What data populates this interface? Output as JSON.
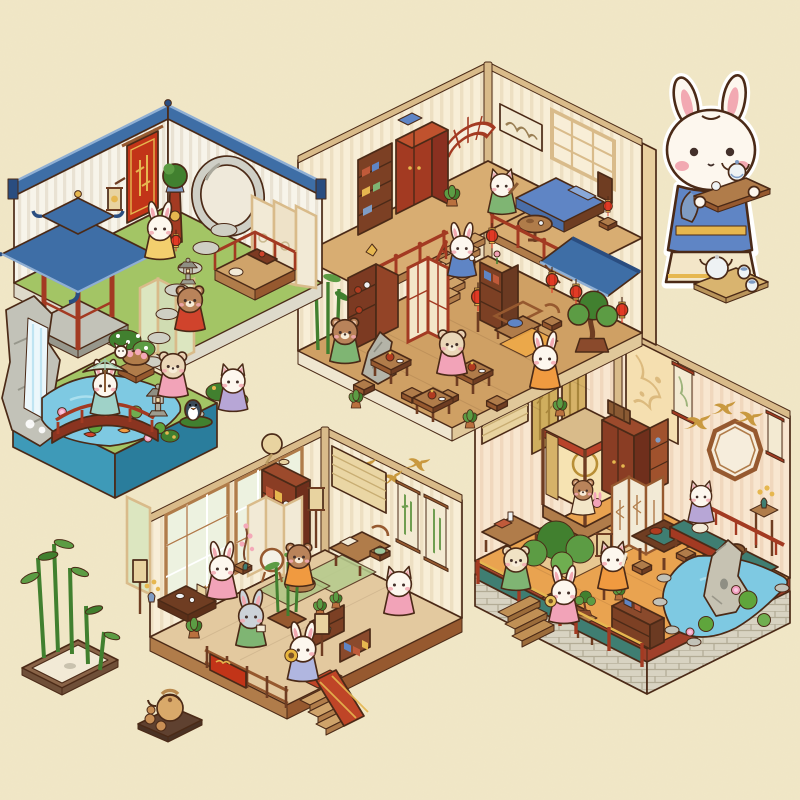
{
  "scene": {
    "description": "Isometric cutaway dollhouse illustration of a traditional Chinese courtyard home with four dioramas - a garden with koi pond and pavilion, a two-story house with bedroom and teahouse, a flower study, and a tea terrace - inhabited by cute rabbit, bear, cat and puppy figures in hanfu, drawn on speckled cream paper",
    "art_style": "pastel isometric storybook game art",
    "canvas": {
      "width": 800,
      "height": 800
    }
  },
  "palette": {
    "bg": "#f1e7c6",
    "speckle": "#d8c89a",
    "outline": "#4b2a17",
    "roofBlue": "#3e6ea6",
    "roofBlueDark": "#2a4d80",
    "roofBlueLight": "#8fafd4",
    "wallWhite": "#f7f4ea",
    "wallWhiteStripe": "#e9e2d3",
    "wallCream": "#f8eed7",
    "wallCreamStripe": "#eddfc2",
    "wallPink": "#f8e6d0",
    "wallPinkStripe": "#f0d7bd",
    "beamTan": "#d9bb8a",
    "woodDark": "#6f3d22",
    "wood": "#96592f",
    "woodMid": "#b07c4a",
    "woodLight": "#cfa36a",
    "woodRed": "#a33a22",
    "woodRedLight": "#c0522e",
    "bannerRed": "#c23418",
    "gold": "#e6b74f",
    "goldDark": "#b98f35",
    "lanternRed": "#e13a25",
    "floorWoodB": "#cfa064",
    "floorWoodBup": "#d8ad72",
    "floorWoodC": "#e3c99f",
    "floorWoodD": "#e9a350",
    "tatami": "#efa948",
    "carpetRed": "#bf4527",
    "grass": "#a3c565",
    "grassDark": "#82aa4c",
    "pond": "#7ec9e2",
    "pondLight": "#aadfee",
    "pondSide": "#3e9ab8",
    "pondSideDark": "#2a7d9c",
    "stone": "#c2c2b8",
    "stoneDark": "#97978c",
    "stoneLight": "#dedacb",
    "screenCeladon": "#dce6c0",
    "screenIvory": "#f2ead6",
    "screenGold": "#d6b268",
    "tealRail": "#3f7e72",
    "leaf": "#5c9c44",
    "leafDark": "#41802f",
    "furWhite": "#fdf7ee",
    "furBrown": "#b9835a",
    "furGrey": "#ccd2d8",
    "furCream": "#f0e2c4",
    "blush": "#f2a9b2",
    "dressBlue": "#5f85c5",
    "dressPink": "#f2a3b8",
    "dressOrange": "#f09a40",
    "dressGreen": "#7fb573",
    "dressPurple": "#b7a6d6",
    "dressRed": "#d0432c",
    "dressYellow": "#f3cf6e",
    "dressTeal": "#9fd2c8",
    "porcelain": "#eef2f4",
    "porcelainBlue": "#7f9cc4",
    "stepTop": "#cfa36a",
    "stepFront": "#b07c4a"
  },
  "rooms": [
    {
      "id": "courtyard-garden",
      "position": "top-left",
      "features": [
        "white walls with blue tiled caps",
        "red bamboo banner",
        "moon gate",
        "blue-roofed pavilion",
        "celadon standing screen",
        "ivory folding screen",
        "red-railed daybed platform",
        "stone path",
        "stone lanterns",
        "waterfall rockery",
        "lotus koi pond",
        "red arched bridge",
        "flower bushes",
        "peach basket",
        "topiary pedestal",
        "wall lantern"
      ],
      "characters": [
        {
          "name": "rabbit-with-red-lantern",
          "species": "rabbit",
          "outfit": "#f3cf6e"
        },
        {
          "name": "bear-in-red-hanfu",
          "species": "bear",
          "outfit": "#d0432c"
        },
        {
          "name": "puppy-in-pink-hanfu",
          "species": "puppy",
          "outfit": "#f2a3b8"
        },
        {
          "name": "rabbit-with-parasol",
          "species": "rabbit",
          "outfit": "#9fd2c8"
        },
        {
          "name": "cat-in-purple-hanfu",
          "species": "cat",
          "outfit": "#b7a6d6"
        },
        {
          "name": "penguin-on-leaf-boat",
          "species": "penguin",
          "outfit": "none"
        },
        {
          "name": "white-kitten",
          "species": "kitten",
          "outfit": "none"
        }
      ]
    },
    {
      "id": "two-story-house",
      "position": "top-right",
      "upper_floor": [
        "red fan lattice window",
        "landscape scroll",
        "lattice window",
        "red wardrobe",
        "bookshelf with books",
        "blue bed",
        "bedside table with lamp",
        "round pedestal table",
        "potted plants",
        "red mezzanine railing",
        "staircase"
      ],
      "lower_floor": [
        "tea display cabinet with gold bird",
        "red lattice partition",
        "corner bamboo",
        "scholar rock",
        "book cabinet",
        "wooden couch with blue cushion",
        "armchair",
        "blue awning with red lanterns",
        "large bonsai",
        "three tea tables with stools",
        "floor lantern",
        "orange mat"
      ],
      "characters": [
        {
          "name": "cat-in-green-hanfu-with-lute",
          "species": "cat",
          "outfit": "#7fb573"
        },
        {
          "name": "rabbit-with-teacup-on-stairs",
          "species": "rabbit",
          "outfit": "#5f85c5"
        },
        {
          "name": "bear-in-green-hanfu",
          "species": "bear",
          "outfit": "#7fb573"
        },
        {
          "name": "puppy-in-pink-apron",
          "species": "puppy",
          "outfit": "#f2a3b8"
        },
        {
          "name": "rabbit-in-orange-dress",
          "species": "rabbit",
          "outfit": "#f09a40"
        }
      ]
    },
    {
      "id": "flower-study",
      "position": "bottom-center",
      "features": [
        "tall lattice windows",
        "celadon side screen",
        "bamboo hanging scroll",
        "palm-leaf fan",
        "swallow wall paintings",
        "roller blind",
        "pair of bamboo scrolls",
        "red display shelf",
        "ivory folding screen",
        "writing desk and chair",
        "plum-blossom arrangement",
        "embroidery hoop stand",
        "low tea table with tea set",
        "bamboo planter",
        "tiered plant stand",
        "book shelf",
        "green floor mats",
        "garden fence with red valance",
        "red-carpet steps",
        "floor lamps",
        "potted flowers"
      ],
      "characters": [
        {
          "name": "rabbit-in-pink-hanfu",
          "species": "rabbit",
          "outfit": "#f2a3b8"
        },
        {
          "name": "grey-rabbit-with-book",
          "species": "rabbit",
          "outfit": "#7fb573"
        },
        {
          "name": "bear-flower-arranger",
          "species": "bear",
          "outfit": "#f09a40"
        },
        {
          "name": "cat-in-pink-dress",
          "species": "cat",
          "outfit": "#f2a3b8"
        },
        {
          "name": "rabbit-with-sunflower",
          "species": "rabbit",
          "outfit": "#b0b6e0"
        }
      ]
    },
    {
      "id": "tea-terrace",
      "position": "bottom-right",
      "features": [
        "floral wall banner",
        "hanging scrolls",
        "octagonal window",
        "swallow wall paintings",
        "canopy bed with gold curtains",
        "red wardrobe with travel chest",
        "lattice folding screen",
        "gold bamboo panels",
        "roller blind",
        "writing desk",
        "square tea table with stools",
        "green-cushioned couch",
        "flower stand",
        "large bonsai",
        "standing lanterns",
        "low book shelf",
        "teal garden railing",
        "stone brick base",
        "wooden steps",
        "lotus pond with scholar rock"
      ],
      "characters": [
        {
          "name": "bear-cub-with-plush",
          "species": "bear",
          "outfit": "#f3e6c8"
        },
        {
          "name": "lamb-in-green-hanfu",
          "species": "lamb",
          "outfit": "#7fb573"
        },
        {
          "name": "rabbit-with-round-fan",
          "species": "rabbit",
          "outfit": "#f2a3b8"
        },
        {
          "name": "cat-in-orange-hanfu-with-brush",
          "species": "cat",
          "outfit": "#f09a40"
        },
        {
          "name": "cat-in-lavender-hanfu",
          "species": "cat",
          "outfit": "#b7a6d6"
        },
        {
          "name": "sleeping-puppy",
          "species": "puppy",
          "outfit": "none"
        }
      ]
    }
  ],
  "props": [
    {
      "id": "mascot-rabbit",
      "description": "large white rabbit in blue hanfu carrying a wooden tray with blue-and-white teapot and cup",
      "position": "top-right"
    },
    {
      "id": "porcelain-tea-set",
      "description": "tray with porcelain teapot and two cups",
      "position": "right-middle"
    },
    {
      "id": "bamboo-planter",
      "description": "rectangular tray planter with live bamboo stalks",
      "position": "bottom-left"
    },
    {
      "id": "clay-tea-set",
      "description": "dark tray with clay teapot and three cups",
      "position": "bottom-center-left"
    }
  ]
}
